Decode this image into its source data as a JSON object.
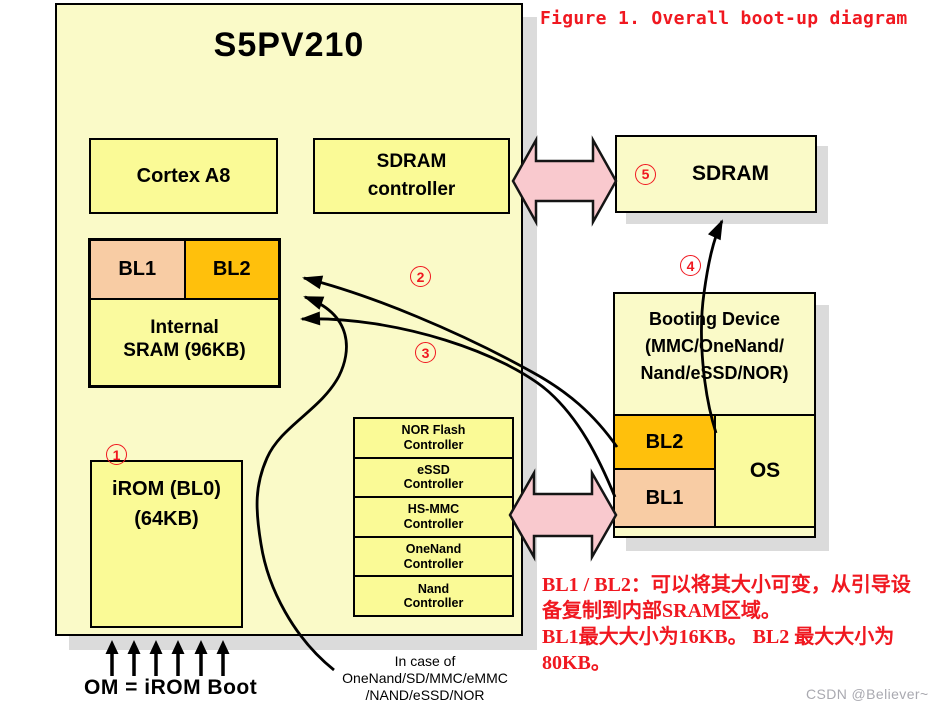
{
  "figure_title": "Figure 1. Overall boot-up diagram",
  "chip": {
    "title": "S5PV210",
    "cortex_label": "Cortex A8",
    "sdram_controller": {
      "line1": "SDRAM",
      "line2": "controller"
    },
    "sram": {
      "bl1": "BL1",
      "bl2": "BL2",
      "line1": "Internal",
      "line2": "SRAM (96KB)"
    },
    "irom": {
      "line1": "iROM (BL0)",
      "line2": "(64KB)"
    },
    "controllers": [
      [
        "NOR Flash",
        "Controller"
      ],
      [
        "eSSD",
        "Controller"
      ],
      [
        "HS-MMC",
        "Controller"
      ],
      [
        "OneNand",
        "Controller"
      ],
      [
        "Nand",
        "Controller"
      ]
    ]
  },
  "right": {
    "sdram_label": "SDRAM",
    "booting_device": {
      "title_line1": "Booting Device",
      "title_line2": "(MMC/OneNand/",
      "title_line3": "Nand/eSSD/NOR)",
      "bl2": "BL2",
      "bl1": "BL1",
      "os": "OS"
    }
  },
  "steps": [
    "1",
    "2",
    "3",
    "4",
    "5"
  ],
  "notes": {
    "in_case_line1": "In case of",
    "in_case_line2": "OneNand/SD/MMC/eMMC",
    "in_case_line3": "/NAND/eSSD/NOR",
    "om_boot": "OM = iROM Boot",
    "red_line1": "BL1 / BL2：可以将其大小可变，从引导设",
    "red_line2": "备复制到内部SRAM区域。",
    "red_line3": "BL1最大大小为16KB。  BL2 最大大小为",
    "red_line4": "80KB。"
  },
  "watermark": "CSDN @Believer~",
  "colors": {
    "chip_background": "#FAFAC8",
    "block_yellow": "#FAFA96",
    "bl1_peach": "#F8CCA4",
    "bl2_orange": "#FFC00C",
    "pink_arrow": "#F9C9CE",
    "shadow_gray": "#DBDBDB",
    "red_text": "#F01820",
    "watermark_gray": "#A9A9B0"
  }
}
